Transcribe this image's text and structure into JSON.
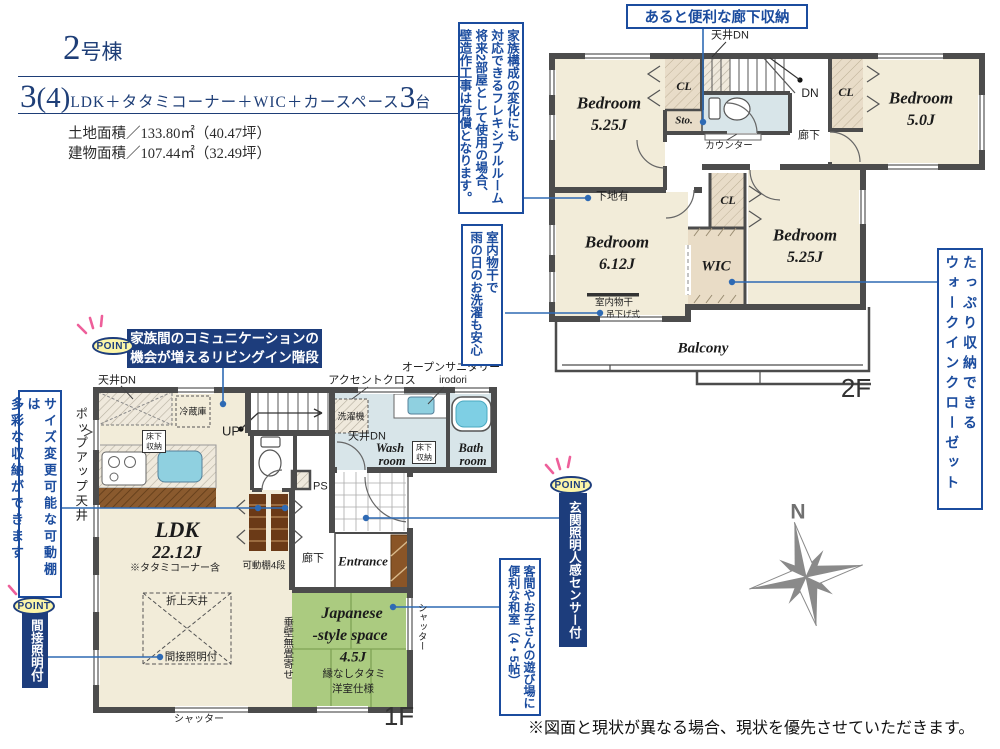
{
  "header": {
    "unit_number": "2",
    "unit_suffix": "号棟",
    "plan_number": "3",
    "plan_paren": "(4)",
    "plan_body": "LDK＋タタミコーナー＋WIC＋カースペース",
    "plan_count": "3",
    "plan_count_suffix": "台",
    "land_area": "土地面積／133.80㎡（40.47坪）",
    "building_area": "建物面積／107.44㎡（32.49坪）"
  },
  "callouts": {
    "point": "POINT",
    "hall_storage": "あると便利な廊下収納",
    "flexible": "家族構成の変化にも\n対応できるフレキシブルルーム\n将来2部屋として使用の場合、\n壁造作工事は有償となります。",
    "laundry": "室内物干で\n雨の日のお洗濯も安心",
    "wic": "たっぷり収納できる\nウォークインクローゼット",
    "shelf": "サイズ変更可能な可動棚は\n多彩な収納ができます",
    "living_stairs_line1": "家族間のコミュニケーションの",
    "living_stairs_line2": "機会が増えるリビングイン階段",
    "indirect": "間接照明付",
    "sensor": "玄関照明人感センサー付",
    "washitsu": "客間やお子さんの遊び場に\n便利な和室（4・5帖）"
  },
  "floor2": {
    "label": "2F",
    "bed1": {
      "name": "Bedroom",
      "size": "5.25J"
    },
    "bed2": {
      "name": "Bedroom",
      "size": "6.12J"
    },
    "bed3": {
      "name": "Bedroom",
      "size": "5.0J"
    },
    "bed4": {
      "name": "Bedroom",
      "size": "5.25J"
    },
    "wic": "WIC",
    "cl1": "CL",
    "cl2": "CL",
    "cl3": "CL",
    "storage": "Sto.",
    "hallway": "廊下",
    "counter": "カウンター",
    "dn": "DN",
    "ceiling_dn": "天井DN",
    "shitaji": "下地有",
    "monohoshi": "室内物干",
    "tsurisage": "吊下げ式",
    "balcony": "Balcony"
  },
  "floor1": {
    "label": "1F",
    "ldk": {
      "name": "LDK",
      "size": "22.12J",
      "note": "※タタミコーナー含"
    },
    "ceiling_dn_kitchen": "天井DN",
    "popup_ceiling": "ポップアップ天井",
    "fridge": "冷蔵庫",
    "underfloor_kitchen": "床下収納",
    "up": "UP",
    "accent_cloth": "アクセントクロス",
    "open_sanitary": "オープンサニタリー",
    "open_sanitary_name": "irodori",
    "washer": "洗濯機",
    "ceiling_dn_wash": "天井DN",
    "wash": {
      "l1": "Wash",
      "l2": "room"
    },
    "underfloor_wash": "床下収納",
    "bath": {
      "l1": "Bath",
      "l2": "room"
    },
    "ps": "PS",
    "shelf": "可動棚4段",
    "hallway": "廊下",
    "entrance": "Entrance",
    "oriage": "折上天井",
    "indirect": "間接照明付",
    "tarekabe": "垂壁無畳寄せ",
    "jp": {
      "l1": "Japanese",
      "l2": "-style space",
      "size": "4.5J",
      "n1": "縁なしタタミ",
      "n2": "洋室仕様"
    },
    "shutter_bottom": "シャッター",
    "shutter_side": "シャッター"
  },
  "compass": {
    "north": "N"
  },
  "footer": {
    "note": "※図面と現状が異なる場合、現状を優先させていただきます。"
  },
  "colors": {
    "wall": "#4c4c4c",
    "title_navy": "#1e3e77",
    "callout_blue": "#1b4c9e",
    "leader_blue": "#2e6ab4",
    "navy_box": "#1d3d7c",
    "room_beige": "#f2ecd9",
    "closet_tan": "#e8dcc8",
    "sanitary_blue": "#d8e5e9",
    "tatami_green": "#abcb80",
    "tub_cyan": "#7ecfe4",
    "point_yellow": "#fcf5a8",
    "point_pink": "#ee5f9a",
    "compass_gray": "#8a8a8a"
  }
}
